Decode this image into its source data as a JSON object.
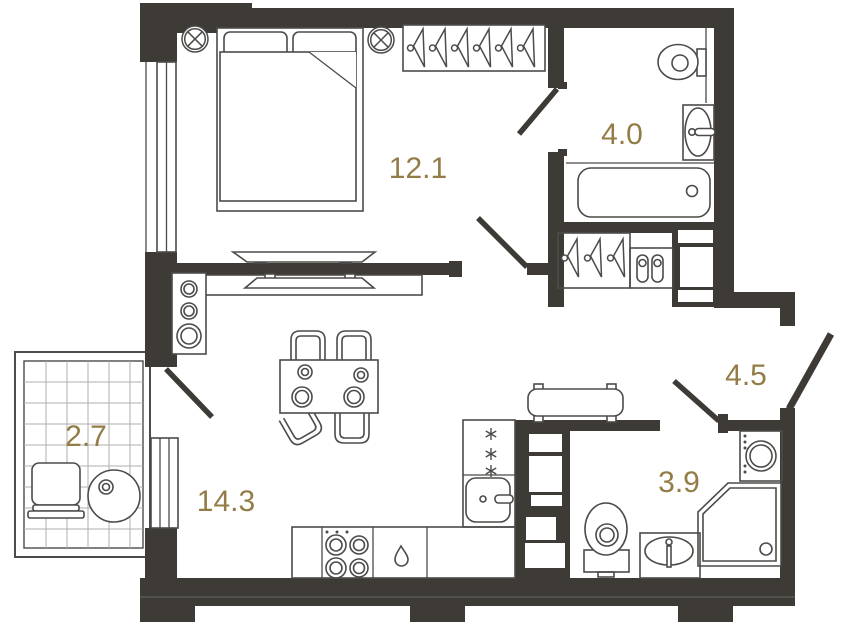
{
  "plan": {
    "rooms": [
      {
        "id": "bedroom",
        "area": "12.1"
      },
      {
        "id": "bathroom",
        "area": "4.0"
      },
      {
        "id": "balcony",
        "area": "2.7"
      },
      {
        "id": "living-kitchen",
        "area": "14.3"
      },
      {
        "id": "hallway",
        "area": "4.5"
      },
      {
        "id": "shower-room",
        "area": "3.9"
      }
    ],
    "colors": {
      "wall": "#3e3b37",
      "room_label": "#937c46",
      "furniture_line": "#4c4b49",
      "balcony_grid": "#b0afac",
      "background": "#ffffff"
    },
    "furniture_counts": {
      "wardrobe_hangers": 6,
      "closet_hangers": 3
    }
  }
}
